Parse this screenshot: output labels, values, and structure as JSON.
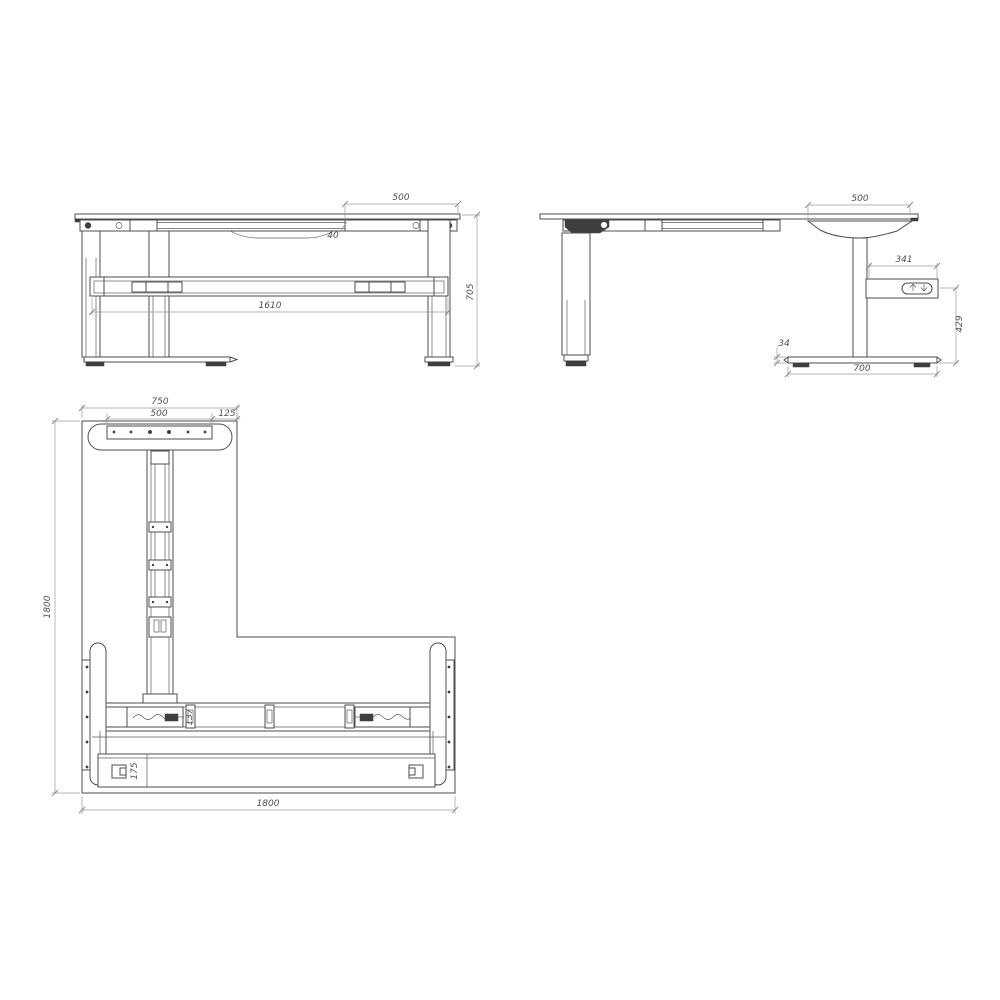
{
  "document": {
    "kind": "standing-desk-technical-drawing",
    "colors": {
      "line": "#4d4d4d",
      "dim_line": "#9b9b9b",
      "dim_text": "#4f4f4f",
      "dark_fill": "#3f3f3f",
      "background": "#ffffff"
    },
    "views": {
      "front": {
        "dims": {
          "top_overhang": "500",
          "top_offset": "40",
          "crossbar_length": "1610",
          "height": "705"
        }
      },
      "side": {
        "icons": {
          "height_adjust": "up-down-arrows"
        },
        "dims": {
          "top_overhang": "500",
          "control_box_width": "341",
          "control_box_height": "429",
          "foot_height": "34",
          "foot_depth": "700"
        }
      },
      "plan": {
        "dims": {
          "foot_width": "750",
          "plate_width": "500",
          "plate_offset": "125",
          "depth_left": "1800",
          "beam_depth": "137",
          "tray_depth": "175",
          "width_bottom": "1800"
        }
      }
    }
  }
}
